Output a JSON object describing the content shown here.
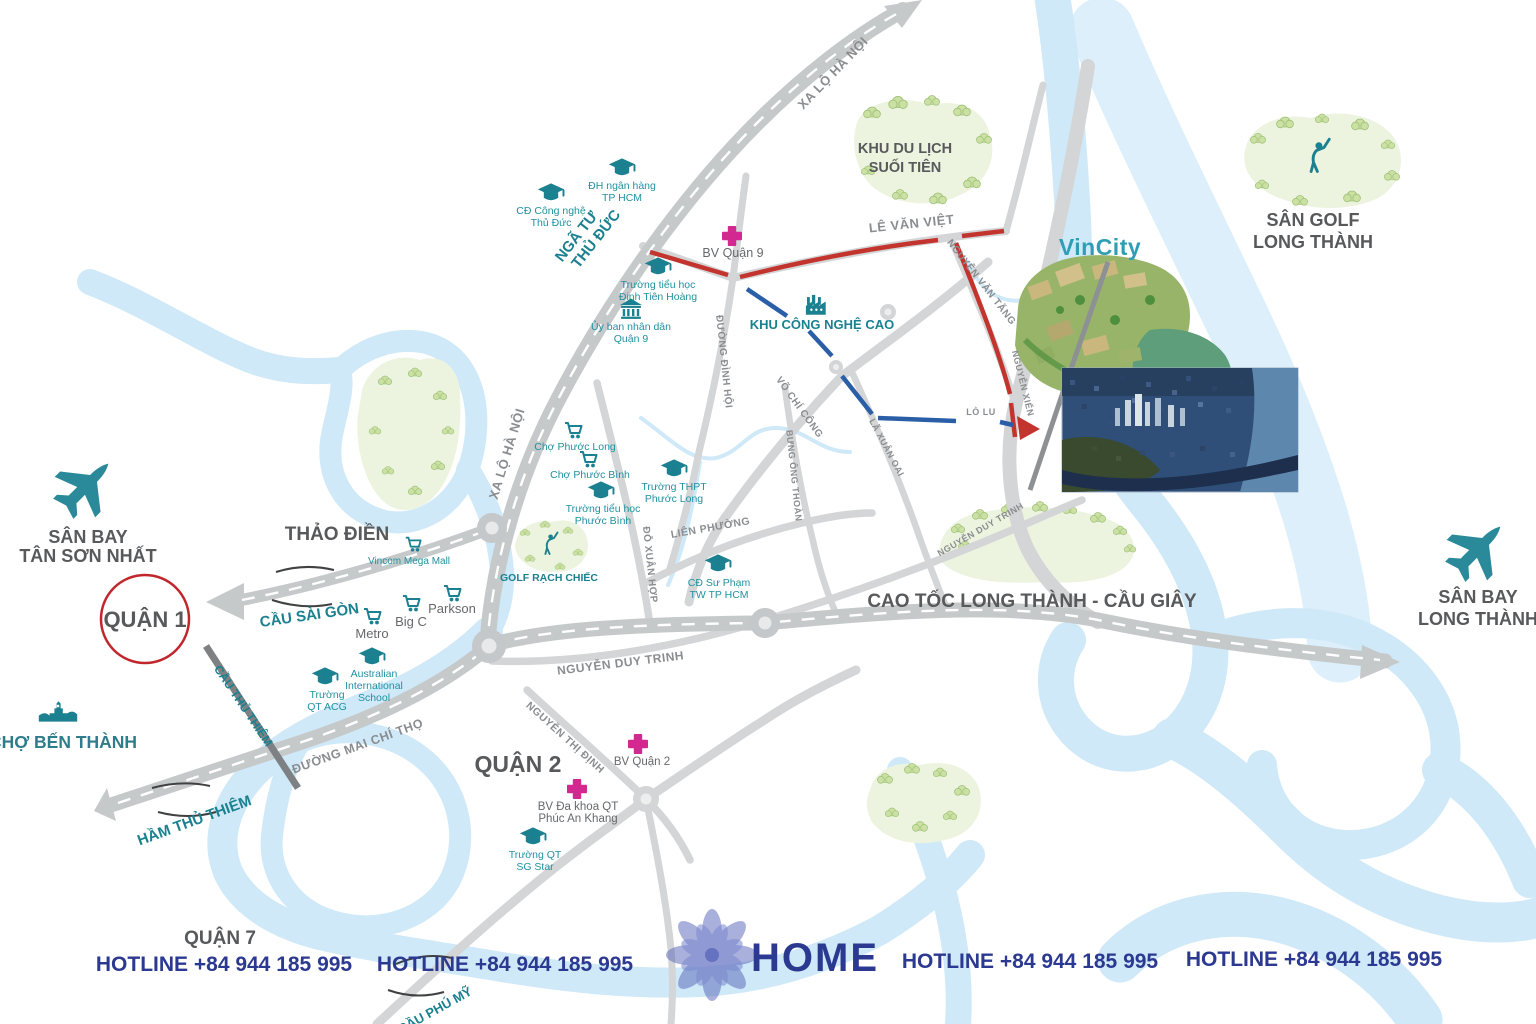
{
  "colors": {
    "teal": "#1B808F",
    "road_gray": "#C6C9CA",
    "river_blue": "#CFE9F8",
    "route_red": "#C4342E",
    "route_blue": "#2A5EA6",
    "hospital_pink": "#D2288F",
    "hotline_navy": "#2B3990",
    "label_gray": "#58595B",
    "vincity_teal": "#2E9DB5",
    "green_area": "#ECF4E0",
    "circle_red": "#C0272D"
  },
  "icons": {
    "plane-icon": "airplane silhouette",
    "graduation-cap-icon": "mortarboard",
    "cart-icon": "shopping cart",
    "hospital-cross-icon": "medical cross",
    "factory-icon": "factory with chimneys",
    "government-building-icon": "columned building",
    "market-icon": "Ben Thanh market facade",
    "golfer-icon": "golfer swinging club",
    "tree-icon": "tree cluster",
    "flower-logo-icon": "eight petal lotus"
  },
  "districts": {
    "quan1": "QUẬN 1",
    "quan2": "QUẬN 2",
    "quan7": "QUẬN 7",
    "thao_dien": "THẢO ĐIỀN"
  },
  "landmarks": {
    "san_bay_tsn": [
      "SÂN BAY",
      "TÂN SƠN NHẤT"
    ],
    "san_bay_long_thanh": [
      "SÂN BAY",
      "LONG THÀNH"
    ],
    "cho_ben_thanh": "CHỢ BẾN THÀNH",
    "suoi_tien": [
      "KHU DU LỊCH",
      "SUỐI TIÊN"
    ],
    "san_golf_long_thanh": [
      "SÂN GOLF",
      "LONG THÀNH"
    ],
    "golf_rach_chiec": "GOLF RẠCH CHIẾC",
    "khu_cong_nghe_cao": "KHU CÔNG NGHỆ CAO",
    "vincity": "VinCity",
    "nga_tu_thu_duc": [
      "NGÃ TƯ",
      "THỦ ĐỨC"
    ]
  },
  "roads": {
    "xa_lo_ha_noi": "XA LỘ HÀ NỘI",
    "le_van_viet": "LÊ VĂN VIỆT",
    "nguyen_van_tang": "NGUYỄN VĂN TĂNG",
    "nguyen_xien": "NGUYỄN XIỂN",
    "duong_dinh_hoi": "ĐƯỜNG ĐÌNH HỘI",
    "do_xuan_hop": "ĐỖ XUÂN HỢP",
    "vo_chi_cong": "VÕ CHÍ CÔNG",
    "la_xuan_oai": "LÃ XUÂN OAI",
    "bung_ong_thoan": "BƯNG ÔNG THOÀN",
    "lien_phuong": "LIÊN PHƯỜNG",
    "lo_lu": "LÒ LU",
    "nguyen_duy_trinh": "NGUYỄN DUY TRINH",
    "cao_toc": "CAO TỐC LONG THÀNH - CẦU GIÂY",
    "nguyen_thi_dinh": "NGUYỄN THỊ ĐỊNH",
    "mai_chi_tho": "ĐƯỜNG MAI CHÍ THỌ"
  },
  "bridges": {
    "cau_sai_gon": "CẦU SÀI GÒN",
    "cau_thu_thiem": "CẦU THỦ THIÊM",
    "ham_thu_thiem": "HẦM THỦ THIÊM",
    "cau_phu_my": "CẦU PHÚ MỸ"
  },
  "pois": {
    "dh_ngan_hang": [
      "ĐH ngân hàng",
      "TP HCM"
    ],
    "cd_cong_nghe": [
      "CĐ Công nghệ",
      "Thủ Đức"
    ],
    "truong_dinh_tien_hoang": [
      "Trường tiểu học",
      "Đinh Tiên Hoàng"
    ],
    "uy_ban_q9": [
      "Ủy ban nhân dân",
      "Quận 9"
    ],
    "bv_quan_9": "BV Quận 9",
    "cho_phuoc_long": "Chợ Phước Long",
    "cho_phuoc_binh": "Chợ Phước Bình",
    "truong_thpt_phuoc_long": [
      "Trường THPT",
      "Phước Long"
    ],
    "truong_th_phuoc_binh": [
      "Trường tiểu học",
      "Phước Bình"
    ],
    "cd_su_pham": [
      "CĐ Sư Phạm",
      "TW TP HCM"
    ],
    "vincom": "Vincom Mega Mall",
    "metro": "Metro",
    "big_c": "Big C",
    "parkson": "Parkson",
    "truong_qt_acg": [
      "Trường",
      "QT ACG"
    ],
    "australian": [
      "Australian",
      "International",
      "School"
    ],
    "bv_quan_2": "BV Quận 2",
    "bv_phuc_an_khang": [
      "BV Đa khoa QT",
      "Phúc An Khang"
    ],
    "truong_qt_sg_star": [
      "Trường QT",
      "SG Star"
    ]
  },
  "footer": {
    "hotline": "HOTLINE +84 944 185 995",
    "logo": "HOME"
  }
}
